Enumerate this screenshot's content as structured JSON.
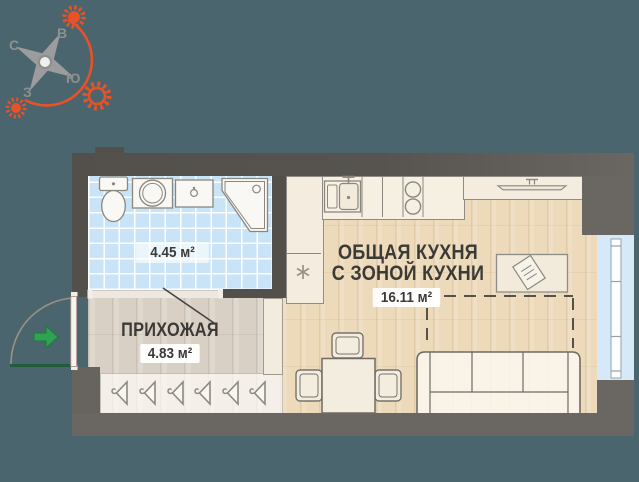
{
  "theme": {
    "--bg": "#4B656E",
    "--wall-dark": "#53504B",
    "--wall-light": "#6A6661",
    "--tile": "#C9E4F7",
    "--laminate": "#D9D0C5",
    "--wood": "#ECDABA",
    "--window": "#D6E9F8",
    "--accent": "#E85226",
    "--arrow-green": "#2EA351",
    "--ink": "#3B3A37"
  },
  "compass": {
    "letters": {
      "north": "С",
      "east": "В",
      "south": "Ю",
      "west": "З"
    },
    "accent_color": "#E85226",
    "star_color": "#9C9C9C"
  },
  "plan": {
    "bathroom": {
      "area": "4.45 м²",
      "floor_color": "#C9E4F7"
    },
    "hallway": {
      "title": "ПРИХОЖАЯ",
      "area": "4.83 м²",
      "floor_color": "#D9D0C5"
    },
    "kitchen": {
      "title_line1": "ОБЩАЯ КУХНЯ",
      "title_line2": "С ЗОНОЙ КУХНИ",
      "area": "16.11 м²",
      "floor_color": "#ECDABA"
    },
    "wall_color_dark": "#53504B",
    "wall_color_light": "#6A6661",
    "window_color": "#D6E9F8",
    "entry_arrow_color": "#2EA351"
  },
  "icons": {
    "compass-star-icon": "4-point star",
    "sun-icon": "orange sun with rays (x3)",
    "sun-path-arc": "orange arc",
    "entry-arrow-icon": "green arrow into apartment",
    "door-swing-arc": "door swing quarter arc",
    "toilet-icon": "tank + bowl",
    "washing-machine-icon": "square with drum circle",
    "sink-vanity-icon": "rectangle with faucet dot",
    "shower-icon": "corner cabin with cut corner",
    "kitchen-sink-icon": "basin with faucet",
    "stove-icon": "two burner circles",
    "tv-icon": "flat screen on shelf",
    "book-icon": "tilted notebook on table",
    "snowflake-icon": "asterisk (fridge position)",
    "hanger-icon": "clothes hanger (x6 in wardrobe)"
  }
}
